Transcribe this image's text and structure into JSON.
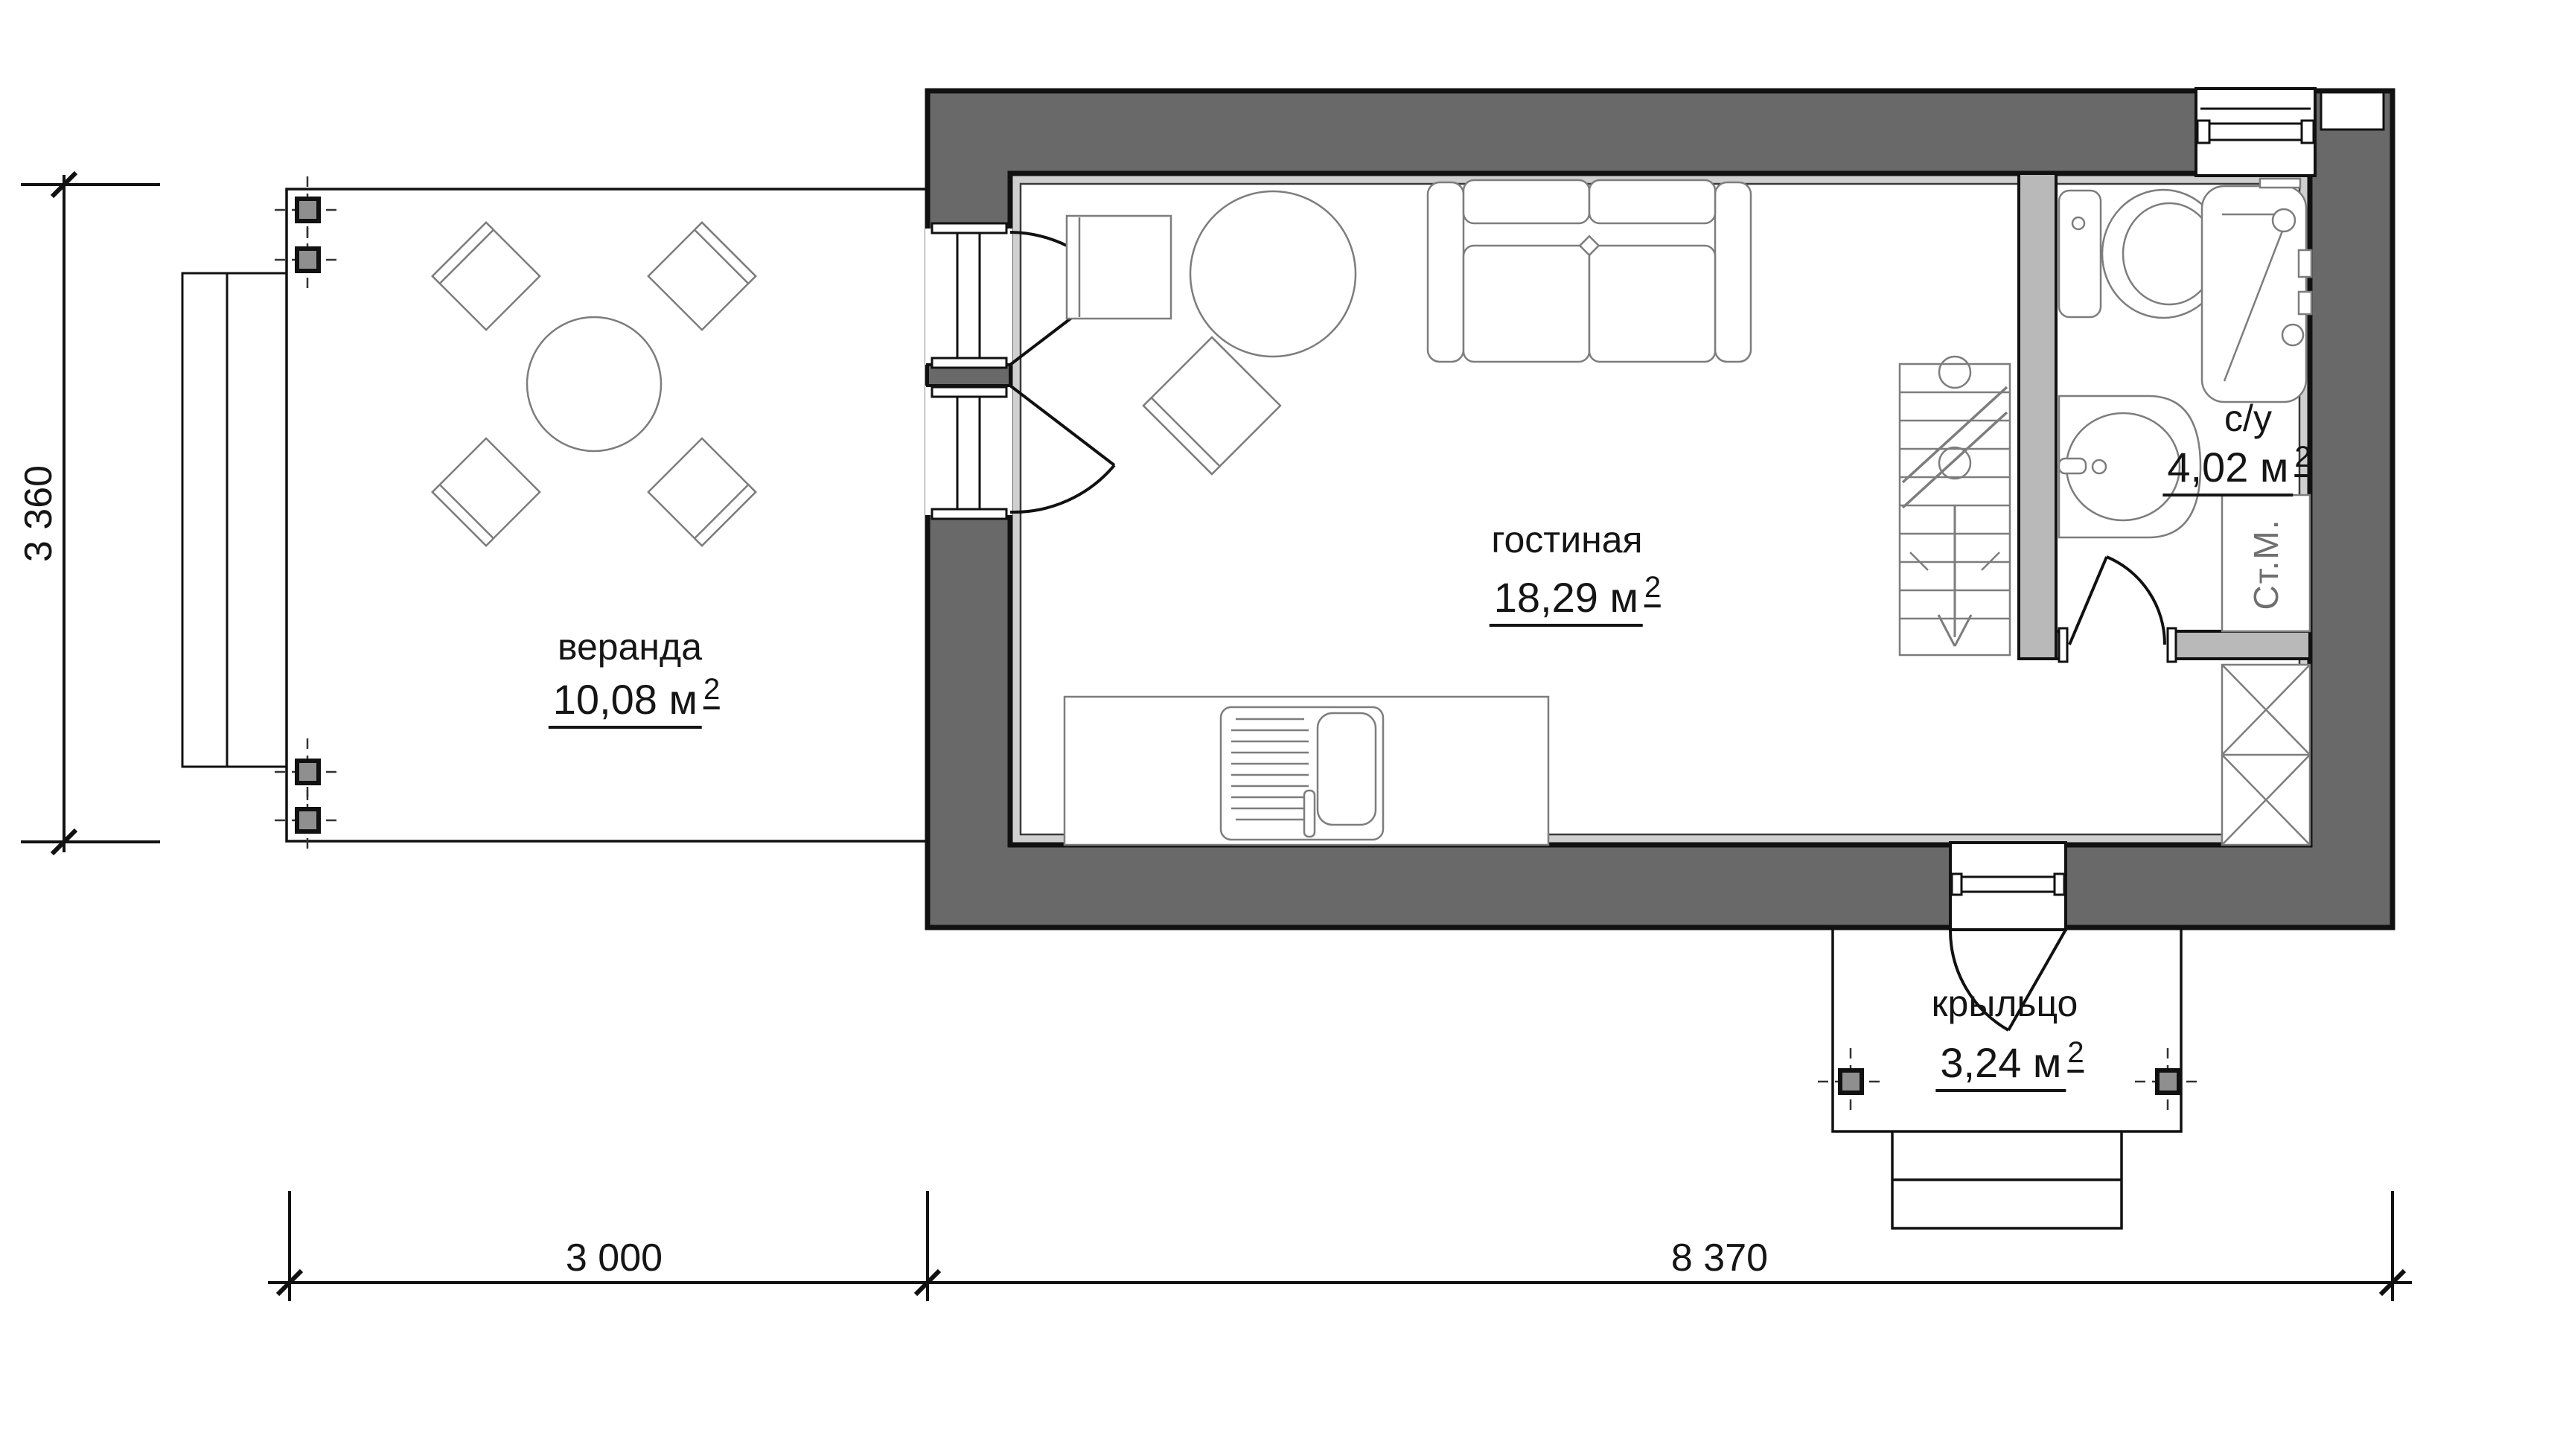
{
  "plan": {
    "type": "floor-plan",
    "rooms": [
      {
        "id": "veranda",
        "name": "веранда",
        "area": "10,08 м",
        "area_sup": "2"
      },
      {
        "id": "living",
        "name": "гостиная",
        "area": "18,29 м",
        "area_sup": "2"
      },
      {
        "id": "bathroom",
        "name": "с/у",
        "area": "4,02 м",
        "area_sup": "2"
      },
      {
        "id": "porch",
        "name": "крыльцо",
        "area": "3,24 м",
        "area_sup": "2"
      }
    ],
    "appliances": {
      "washing_machine": "Ст.М."
    },
    "dimensions": {
      "left_height": "3 360",
      "bottom_left": "3 000",
      "bottom_right": "8 370"
    },
    "colors": {
      "wall": "#696969",
      "partition": "#b9b9b9",
      "finish": "#cfcfcf",
      "furniture": "#7d7d7d",
      "ink": "#111111",
      "post": "#8f8f8f"
    }
  }
}
